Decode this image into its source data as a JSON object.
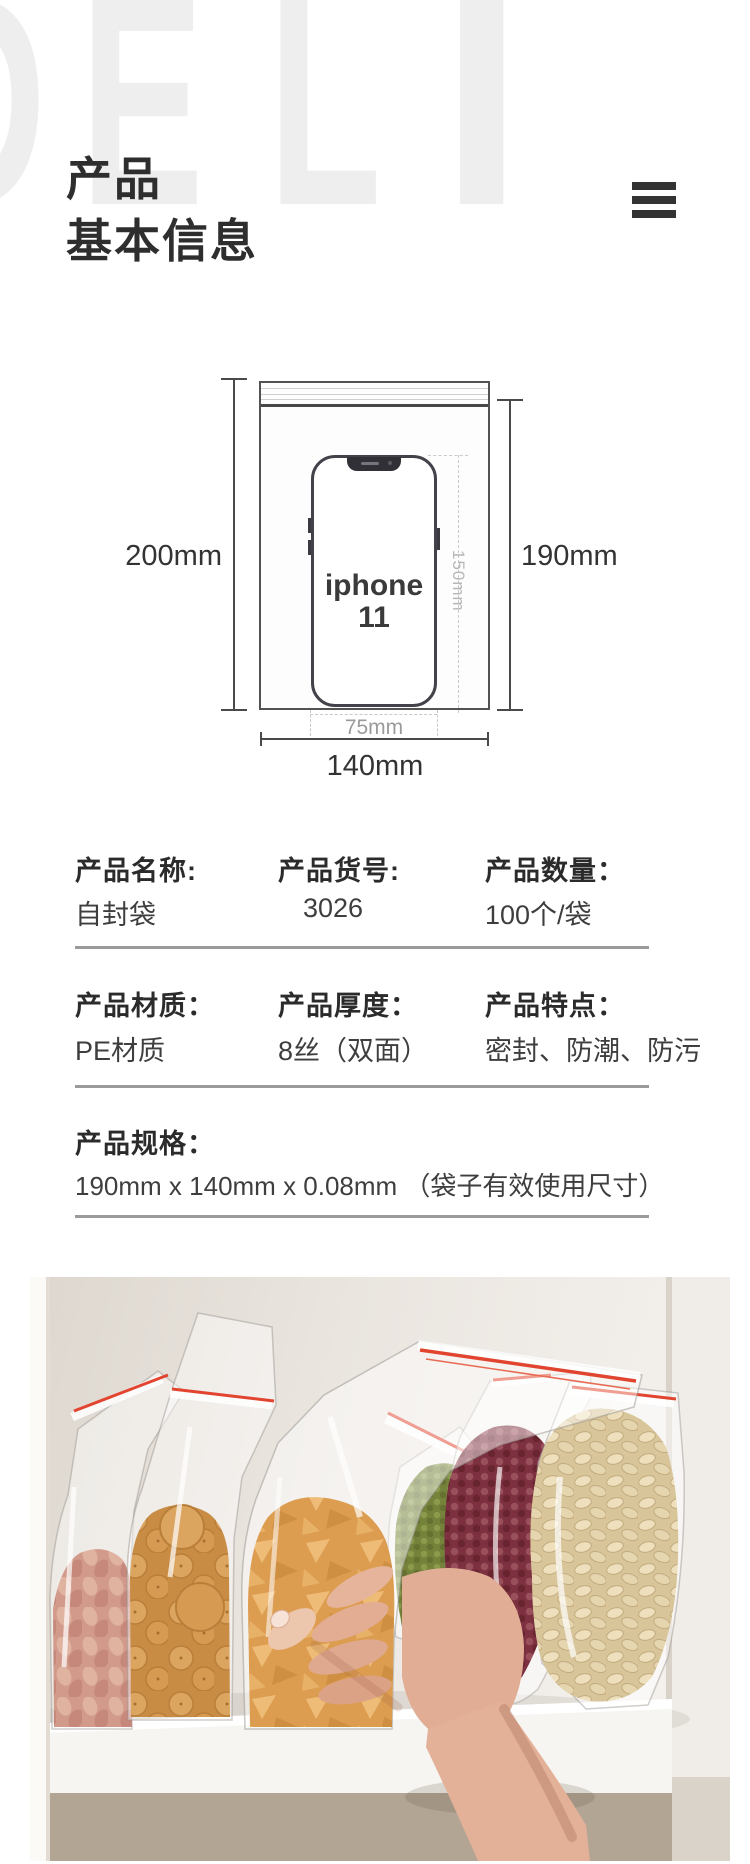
{
  "watermark": {
    "letters": [
      "D",
      "E",
      "L",
      "I"
    ]
  },
  "header": {
    "title_line1": "产品",
    "title_line2": "基本信息"
  },
  "menu": {
    "icon": "hamburger-menu"
  },
  "diagram": {
    "total_height": "200mm",
    "inner_height": "190mm",
    "width": "140mm",
    "phone_height": "150mm",
    "phone_width": "75mm",
    "phone_label_line1": "iphone",
    "phone_label_line2": "11"
  },
  "specs": {
    "row1": [
      {
        "label": "产品名称:",
        "value": "自封袋"
      },
      {
        "label": "产品货号:",
        "value": "3026"
      },
      {
        "label": "产品数量：",
        "value": "100个/袋"
      }
    ],
    "row2": [
      {
        "label": "产品材质：",
        "value": "PE材质"
      },
      {
        "label": "产品厚度：",
        "value": "8丝（双面）"
      },
      {
        "label": "产品特点：",
        "value": "密封、防潮、防污"
      }
    ],
    "row3": {
      "label": "产品规格：",
      "value": "190mm x 140mm x 0.08mm （袋子有效使用尺寸）"
    }
  },
  "photo": {
    "bags": [
      "peanuts",
      "crackers",
      "corn-cone-snacks",
      "mung-beans",
      "red-adzuki-beans",
      "pumpkin-seeds"
    ],
    "colors": {
      "zipper_red": "#e2452f",
      "peanuts": "#d29a8b",
      "crackers": "#d2974f",
      "cones": "#e0a055",
      "mung_beans": "#74823a",
      "adzuki_beans": "#7c3040",
      "pumpkin_seeds": "#dfcda4",
      "wall": "#eae5df",
      "shelf_shadow": "#b3a593",
      "skin": "#dfab92"
    }
  }
}
